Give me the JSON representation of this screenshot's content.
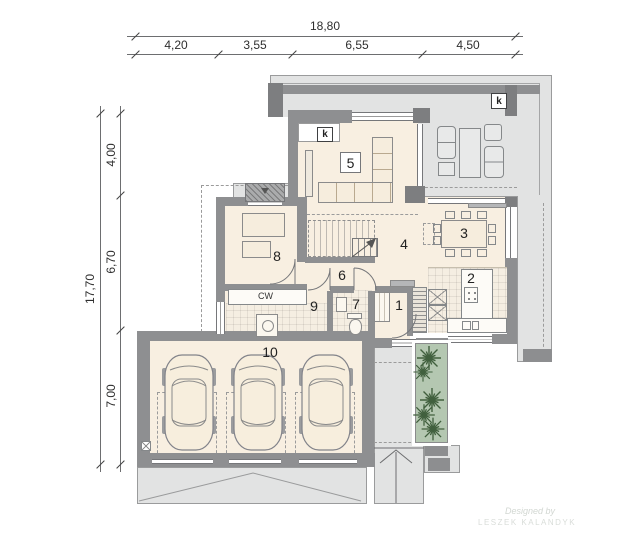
{
  "dimensions": {
    "top": {
      "total": "18,80",
      "s0": "4,20",
      "s1": "3,55",
      "s2": "6,55",
      "s3": "4,50"
    },
    "left": {
      "total": "17,70",
      "s0": "4,00",
      "s1": "6,70",
      "s2": "7,00"
    }
  },
  "rooms": {
    "r1": "1",
    "r2": "2",
    "r3": "3",
    "r4": "4",
    "r5": "5",
    "r6": "6",
    "r7": "7",
    "r8": "8",
    "r9": "9",
    "r10": "10"
  },
  "markers": {
    "k_terrace": "k",
    "k_living": "k",
    "closet": "CW"
  },
  "watermark": {
    "line1": "Designed by",
    "line2": "LESZEK KALANDYK"
  },
  "colors": {
    "floor": "#f8efe1",
    "wall": "#8e8f91",
    "paving": "#e2e3e3",
    "planter": "#b4c7b1",
    "fern": "#41603e"
  }
}
